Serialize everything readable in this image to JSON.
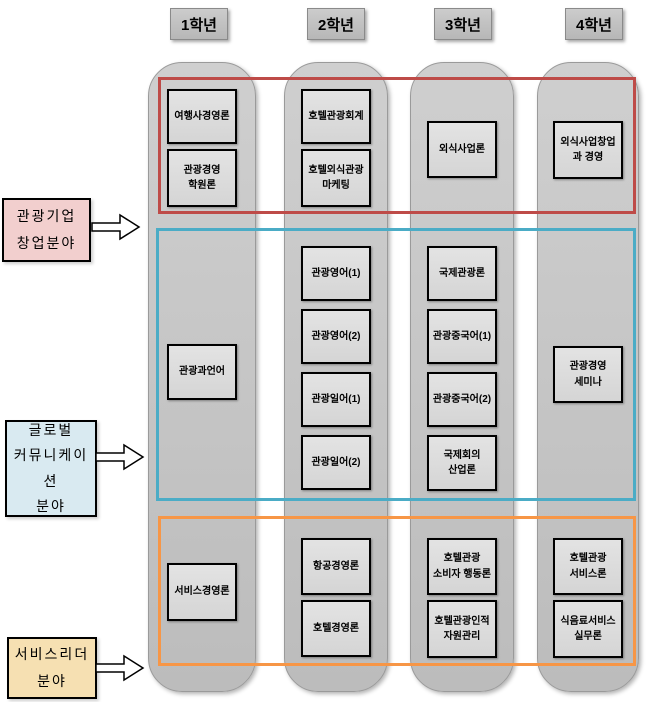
{
  "headers": [
    "1학년",
    "2학년",
    "3학년",
    "4학년"
  ],
  "areas": {
    "startup": {
      "label": "관광기업\n창업분야"
    },
    "global": {
      "label": "글로벌\n커뮤니케이션\n분야"
    },
    "service": {
      "label": "서비스리더\n분야"
    }
  },
  "colors": {
    "band-red": "#BE4B48",
    "band-blue": "#4BACC6",
    "band-orange": "#F79646",
    "label-pink": "#F2CFCE",
    "label-blue": "#D9EAF1",
    "label-tan": "#F6E0B2"
  },
  "courses": {
    "y1": [
      "여행사경영론",
      "관광경영\n학원론",
      "관광과언어",
      "서비스경영론"
    ],
    "y2": [
      "호텔관광회계",
      "호텔외식관광\n마케팅",
      "관광영어(1)",
      "관광영어(2)",
      "관광일어(1)",
      "관광일어(2)",
      "항공경영론",
      "호텔경영론"
    ],
    "y3": [
      "외식사업론",
      "국제관광론",
      "관광중국어(1)",
      "관광중국어(2)",
      "국제회의\n산업론",
      "호텔관광\n소비자 행동론",
      "호텔관광인적\n자원관리"
    ],
    "y4": [
      "외식사업창업\n과 경영",
      "관광경영\n세미나",
      "호텔관광\n서비스론",
      "식음료서비스\n실무론"
    ]
  }
}
